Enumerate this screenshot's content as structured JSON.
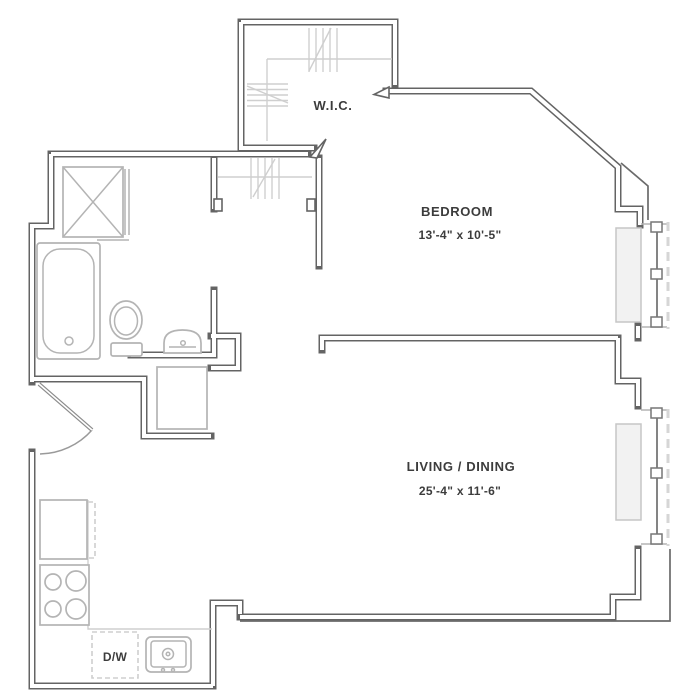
{
  "plan": {
    "title": "One-bedroom apartment floor plan",
    "rooms": {
      "wic": {
        "label": "W.I.C."
      },
      "bedroom": {
        "label": "BEDROOM",
        "dimensions": "13'-4\" x 10'-5\""
      },
      "living_dining": {
        "label": "LIVING / DINING",
        "dimensions": "25'-4\" x 11'-6\""
      }
    },
    "appliances": {
      "dishwasher": {
        "label": "D/W"
      }
    },
    "fixtures": [
      "bathtub",
      "toilet",
      "bathroom-sink",
      "shower",
      "closet-rods",
      "refrigerator",
      "range-4-burners",
      "kitchen-sink",
      "dishwasher",
      "entry-door-swing",
      "window-with-radiator-bedroom",
      "window-with-radiator-living",
      "shaft"
    ],
    "colors": {
      "wall": "#646464",
      "fixture": "#b4b4b4",
      "text": "#3c3c3c",
      "light_line": "#cfcfcf",
      "background": "#ffffff"
    }
  }
}
